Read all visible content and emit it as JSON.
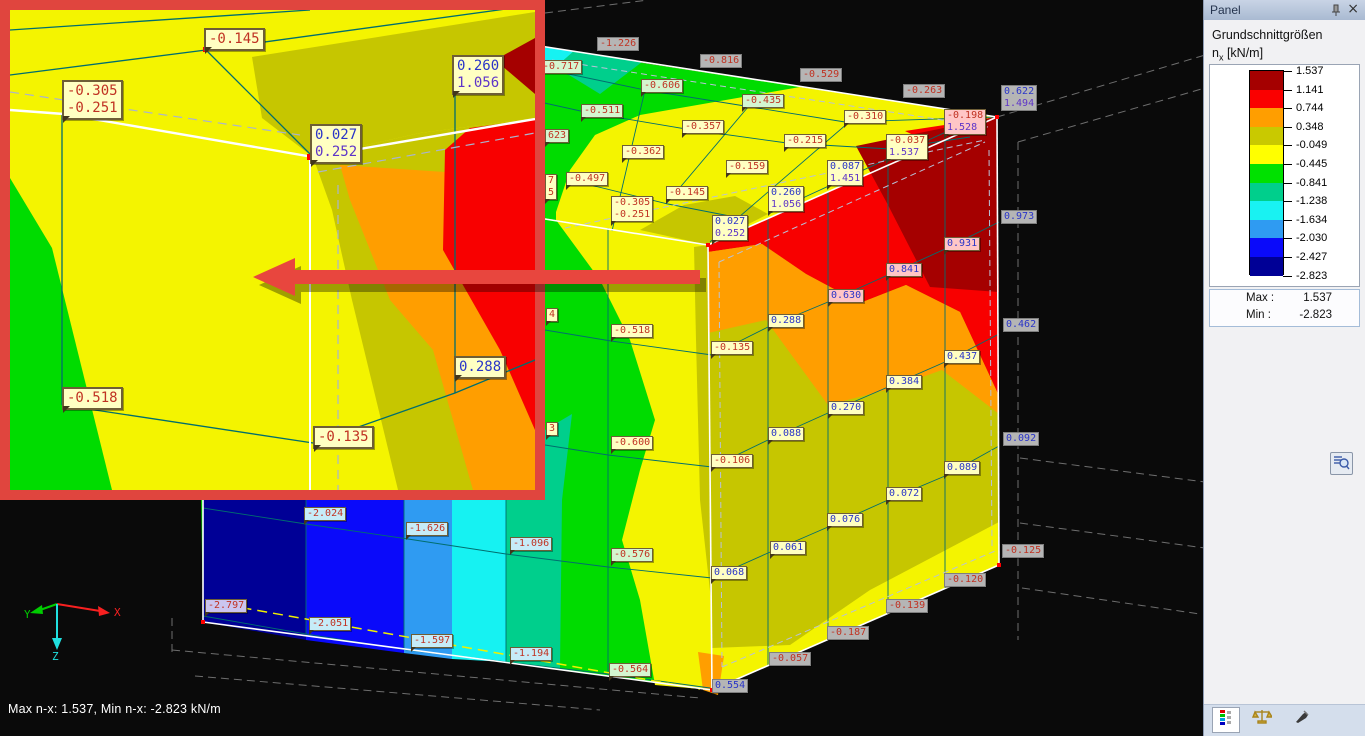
{
  "window": {
    "statusbar_text": "Max n-x: 1.537, Min n-x: -2.823 kN/m"
  },
  "panel": {
    "title": "Panel",
    "section_title": "Grundschnittgrößen",
    "quantity": {
      "symbol": "n",
      "subscript": "x",
      "unit": "[kN/m]"
    },
    "legend": {
      "colors": [
        "#a50000",
        "#fa0000",
        "#ff9e00",
        "#c9c900",
        "#ffff00",
        "#00e100",
        "#00cf8c",
        "#19f2f2",
        "#2f9bf2",
        "#0a0afa",
        "#000096"
      ],
      "values": [
        "1.537",
        "1.141",
        "0.744",
        "0.348",
        "-0.049",
        "-0.445",
        "-0.841",
        "-1.238",
        "-1.634",
        "-2.030",
        "-2.427",
        "-2.823"
      ]
    },
    "summary": {
      "max_label": "Max :",
      "max_value": "1.537",
      "min_label": "Min :",
      "min_value": "-2.823"
    }
  },
  "axes": {
    "x": "X",
    "y": "Y",
    "z": "Z"
  },
  "main_labels": [
    {
      "t": [
        "-1.226"
      ],
      "x": 597,
      "y": 37,
      "s": "k"
    },
    {
      "t": [
        "-0.816"
      ],
      "x": 700,
      "y": 54,
      "s": "k"
    },
    {
      "t": [
        "-0.529"
      ],
      "x": 800,
      "y": 68,
      "s": "k"
    },
    {
      "t": [
        "-0.263"
      ],
      "x": 903,
      "y": 84,
      "s": "k"
    },
    {
      "t": [
        "0.622",
        "1.494"
      ],
      "x": 1001,
      "y": 85,
      "s": "k"
    },
    {
      "t": [
        "0.973"
      ],
      "x": 1001,
      "y": 210,
      "s": "k"
    },
    {
      "t": [
        "0.462"
      ],
      "x": 1003,
      "y": 318,
      "s": "k"
    },
    {
      "t": [
        "0.092"
      ],
      "x": 1003,
      "y": 432,
      "s": "k"
    },
    {
      "t": [
        "-0.125"
      ],
      "x": 1002,
      "y": 544,
      "s": "k"
    },
    {
      "t": [
        "-0.120"
      ],
      "x": 944,
      "y": 573,
      "s": "k"
    },
    {
      "t": [
        "-0.139"
      ],
      "x": 886,
      "y": 599,
      "s": "k"
    },
    {
      "t": [
        "-0.187"
      ],
      "x": 827,
      "y": 626,
      "s": "k"
    },
    {
      "t": [
        "-0.057"
      ],
      "x": 769,
      "y": 652,
      "s": "k"
    },
    {
      "t": [
        "0.554"
      ],
      "x": 712,
      "y": 679,
      "s": "k"
    },
    {
      "t": [
        "-2.797"
      ],
      "x": 205,
      "y": 599,
      "s": "l"
    },
    {
      "t": [
        "-0.717"
      ],
      "x": 540,
      "y": 60,
      "s": "g"
    },
    {
      "t": [
        "-0.606"
      ],
      "x": 641,
      "y": 79,
      "s": "g"
    },
    {
      "t": [
        "-0.511"
      ],
      "x": 581,
      "y": 104,
      "s": "g"
    },
    {
      "t": [
        "-0.435"
      ],
      "x": 742,
      "y": 94,
      "s": "g"
    },
    {
      "t": [
        "-0.357"
      ],
      "x": 682,
      "y": 120,
      "s": "y"
    },
    {
      "t": [
        "-0.362"
      ],
      "x": 622,
      "y": 145,
      "s": "y"
    },
    {
      "t": [
        "-0.310"
      ],
      "x": 844,
      "y": 110,
      "s": "y"
    },
    {
      "t": [
        "-0.215"
      ],
      "x": 784,
      "y": 134,
      "s": "y"
    },
    {
      "t": [
        "-0.159"
      ],
      "x": 726,
      "y": 160,
      "s": "y"
    },
    {
      "t": [
        "-0.145"
      ],
      "x": 666,
      "y": 186,
      "s": "y"
    },
    {
      "t": [
        "-0.497"
      ],
      "x": 566,
      "y": 172,
      "s": "y"
    },
    {
      "t": [
        "-0.305",
        "-0.251"
      ],
      "x": 611,
      "y": 196,
      "s": "y"
    },
    {
      "t": [
        "0.027",
        "0.252"
      ],
      "x": 712,
      "y": 215,
      "s": "y"
    },
    {
      "t": [
        "0.260",
        "1.056"
      ],
      "x": 768,
      "y": 186,
      "s": "y"
    },
    {
      "t": [
        "0.087",
        "1.451"
      ],
      "x": 827,
      "y": 160,
      "s": "y"
    },
    {
      "t": [
        "-0.037",
        "1.537"
      ],
      "x": 886,
      "y": 134,
      "s": "y"
    },
    {
      "t": [
        "-0.198",
        "1.528"
      ],
      "x": 944,
      "y": 109,
      "s": "p"
    },
    {
      "t": [
        "0.288"
      ],
      "x": 768,
      "y": 314,
      "s": "y"
    },
    {
      "t": [
        "0.630"
      ],
      "x": 828,
      "y": 289,
      "s": "p"
    },
    {
      "t": [
        "0.841"
      ],
      "x": 886,
      "y": 263,
      "s": "p"
    },
    {
      "t": [
        "0.931"
      ],
      "x": 944,
      "y": 237,
      "s": "p"
    },
    {
      "t": [
        "0.437"
      ],
      "x": 944,
      "y": 350,
      "s": "y"
    },
    {
      "t": [
        "0.384"
      ],
      "x": 886,
      "y": 375,
      "s": "y"
    },
    {
      "t": [
        "0.270"
      ],
      "x": 828,
      "y": 401,
      "s": "y"
    },
    {
      "t": [
        "0.088"
      ],
      "x": 768,
      "y": 427,
      "s": "y"
    },
    {
      "t": [
        "0.089"
      ],
      "x": 944,
      "y": 461,
      "s": "y"
    },
    {
      "t": [
        "0.072"
      ],
      "x": 886,
      "y": 487,
      "s": "y"
    },
    {
      "t": [
        "0.076"
      ],
      "x": 827,
      "y": 513,
      "s": "y"
    },
    {
      "t": [
        "0.061"
      ],
      "x": 770,
      "y": 541,
      "s": "y"
    },
    {
      "t": [
        "0.068"
      ],
      "x": 711,
      "y": 566,
      "s": "y"
    },
    {
      "t": [
        "-0.135"
      ],
      "x": 711,
      "y": 341,
      "s": "y"
    },
    {
      "t": [
        "-0.106"
      ],
      "x": 711,
      "y": 454,
      "s": "y"
    },
    {
      "t": [
        "-0.518"
      ],
      "x": 611,
      "y": 324,
      "s": "y"
    },
    {
      "t": [
        "-0.600"
      ],
      "x": 611,
      "y": 436,
      "s": "y"
    },
    {
      "t": [
        "-0.576"
      ],
      "x": 611,
      "y": 548,
      "s": "g"
    },
    {
      "t": [
        "-0.564"
      ],
      "x": 609,
      "y": 663,
      "s": "g"
    },
    {
      "t": [
        "-2.024"
      ],
      "x": 304,
      "y": 507,
      "s": "c"
    },
    {
      "t": [
        "-1.626"
      ],
      "x": 406,
      "y": 522,
      "s": "c"
    },
    {
      "t": [
        "-1.096"
      ],
      "x": 510,
      "y": 537,
      "s": "c"
    },
    {
      "t": [
        "-2.051"
      ],
      "x": 309,
      "y": 617,
      "s": "c"
    },
    {
      "t": [
        "-1.597"
      ],
      "x": 411,
      "y": 634,
      "s": "c"
    },
    {
      "t": [
        "-1.194"
      ],
      "x": 510,
      "y": 647,
      "s": "c"
    },
    {
      "t": [
        "623"
      ],
      "x": 545,
      "y": 129,
      "s": "g",
      "c": [
        "neg"
      ]
    },
    {
      "t": [
        "7",
        "5"
      ],
      "x": 545,
      "y": 174,
      "s": "y",
      "c": [
        "neg",
        "neg"
      ]
    },
    {
      "t": [
        "4"
      ],
      "x": 546,
      "y": 308,
      "s": "y",
      "c": [
        "neg"
      ]
    },
    {
      "t": [
        "3"
      ],
      "x": 546,
      "y": 422,
      "s": "y",
      "c": [
        "neg"
      ]
    }
  ],
  "inset_labels": [
    {
      "t": [
        "-0.145"
      ],
      "x": 204,
      "y": 28,
      "s": "y"
    },
    {
      "t": [
        "-0.305",
        "-0.251"
      ],
      "x": 62,
      "y": 80,
      "s": "y"
    },
    {
      "t": [
        "0.260",
        "1.056"
      ],
      "x": 452,
      "y": 55,
      "s": "y"
    },
    {
      "t": [
        "0.027",
        "0.252"
      ],
      "x": 310,
      "y": 124,
      "s": "y"
    },
    {
      "t": [
        "-0.518"
      ],
      "x": 62,
      "y": 387,
      "s": "y"
    },
    {
      "t": [
        "0.288"
      ],
      "x": 454,
      "y": 356,
      "s": "y"
    },
    {
      "t": [
        "-0.135"
      ],
      "x": 313,
      "y": 426,
      "s": "y"
    }
  ]
}
